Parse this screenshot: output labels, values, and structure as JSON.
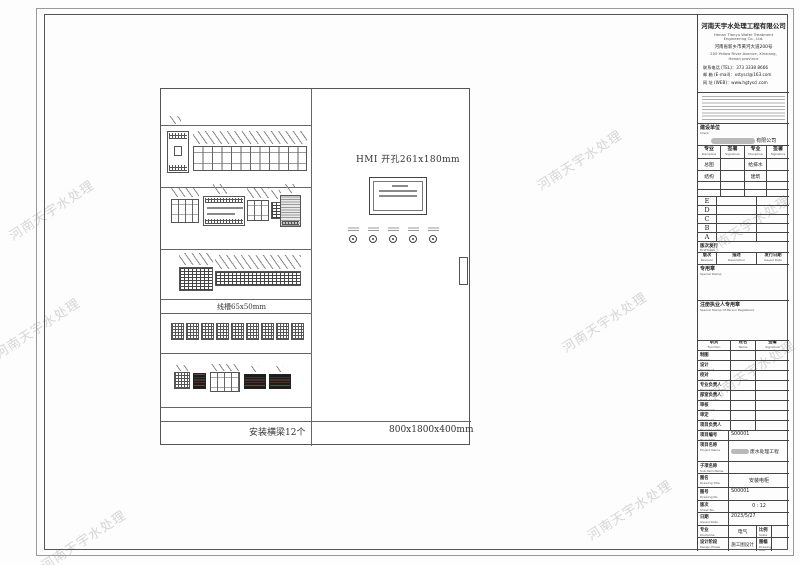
{
  "watermark": {
    "text": "河南天宇水处理"
  },
  "company": {
    "name_cn": "河南天宇水处理工程有限公司",
    "name_en": "Henan Tianyu Water Treatment Engineering Co., Ltd.",
    "address_cn": "河南省新乡市黄河大道200号",
    "address_en": "200 Yellow River Avenue, Xinxiang, Henan province",
    "tel": "联系电话 (TEL)：373 3338 8666",
    "email": "邮  箱 (E-mail)：xstyscl@163.com",
    "web": "网  址 (WEB)：www.hgtyscl.com"
  },
  "drawing": {
    "hmi_cutout_label": "HMI 开孔261x180mm",
    "duct_label": "线槽65x50mm",
    "beam_label": "安装横梁12个",
    "cabinet_size_label": "800x1800x400mm"
  },
  "titleblock": {
    "client": {
      "label_cn": "建设单位",
      "label_en": "Client",
      "value_suffix": "有限公司"
    },
    "disc": {
      "h_spec_cn": "专业",
      "h_spec_en": "Discipline",
      "h_sign_cn": "签署",
      "h_sign_en": "Signature",
      "rows": [
        {
          "left": "总图",
          "right": "给排水"
        },
        {
          "left": "结构",
          "right": "建筑"
        }
      ]
    },
    "revisions": [
      "E",
      "D",
      "C",
      "B",
      "A"
    ],
    "first_issue": {
      "cn": "版次发行",
      "en": "First Issue"
    },
    "rev_header": {
      "rev_cn": "版次",
      "rev_en": "Revision",
      "desc_cn": "描述",
      "desc_en": "Description",
      "date_cn": "发行日期",
      "date_en": "Issued Date"
    },
    "special_stamp": {
      "cn": "专用章",
      "en": "Special Stamp"
    },
    "registered_stamp": {
      "cn": "注册执业人专用章",
      "en": "Special Stamp Of Person Registered"
    },
    "personnel": {
      "header": [
        {
          "cn": "职责",
          "en": "Function"
        },
        {
          "cn": "姓名",
          "en": "Name"
        },
        {
          "cn": "签署",
          "en": "Signature"
        }
      ],
      "rows": [
        {
          "cn": "制图",
          "en": "Drawn"
        },
        {
          "cn": "设计",
          "en": "Designed"
        },
        {
          "cn": "校对",
          "en": "Checked"
        },
        {
          "cn": "专业负责人",
          "en": "Discipline Leader"
        },
        {
          "cn": "部室负责人",
          "en": "Dept. Leader"
        },
        {
          "cn": "审核",
          "en": "Reviewed"
        },
        {
          "cn": "审定",
          "en": "Approved"
        },
        {
          "cn": "项目负责人",
          "en": "Project Leader"
        }
      ]
    },
    "info": {
      "project_no": {
        "cn": "项目编号",
        "en": "Project No.",
        "value": "S00001"
      },
      "project_name": {
        "cn": "项目名称",
        "en": "Project Name",
        "value": "废水处理工程"
      },
      "subitem": {
        "cn": "子项名称",
        "en": "Sub-item Name",
        "value": ""
      },
      "title": {
        "cn": "图名",
        "en": "Drawing Title",
        "value": "安装电柜"
      },
      "dwg_no": {
        "cn": "图号",
        "en": "Drawing No.",
        "value": "S00001"
      },
      "sheet": {
        "cn": "版次",
        "en": "Sheet No.",
        "value": "0 : 12"
      },
      "date": {
        "cn": "日期",
        "en": "Issued Date",
        "value": "2023/5/27"
      },
      "discipline": {
        "cn": "专业",
        "en": "Discipline",
        "value": "电气"
      },
      "scale": {
        "cn": "比例",
        "en": "Scale",
        "value": ""
      },
      "phase": {
        "cn": "设计阶段",
        "en": "Design Phase",
        "value": "施工图设计"
      },
      "size": {
        "cn": "图幅",
        "en": "Drawing size",
        "value": ""
      }
    }
  }
}
